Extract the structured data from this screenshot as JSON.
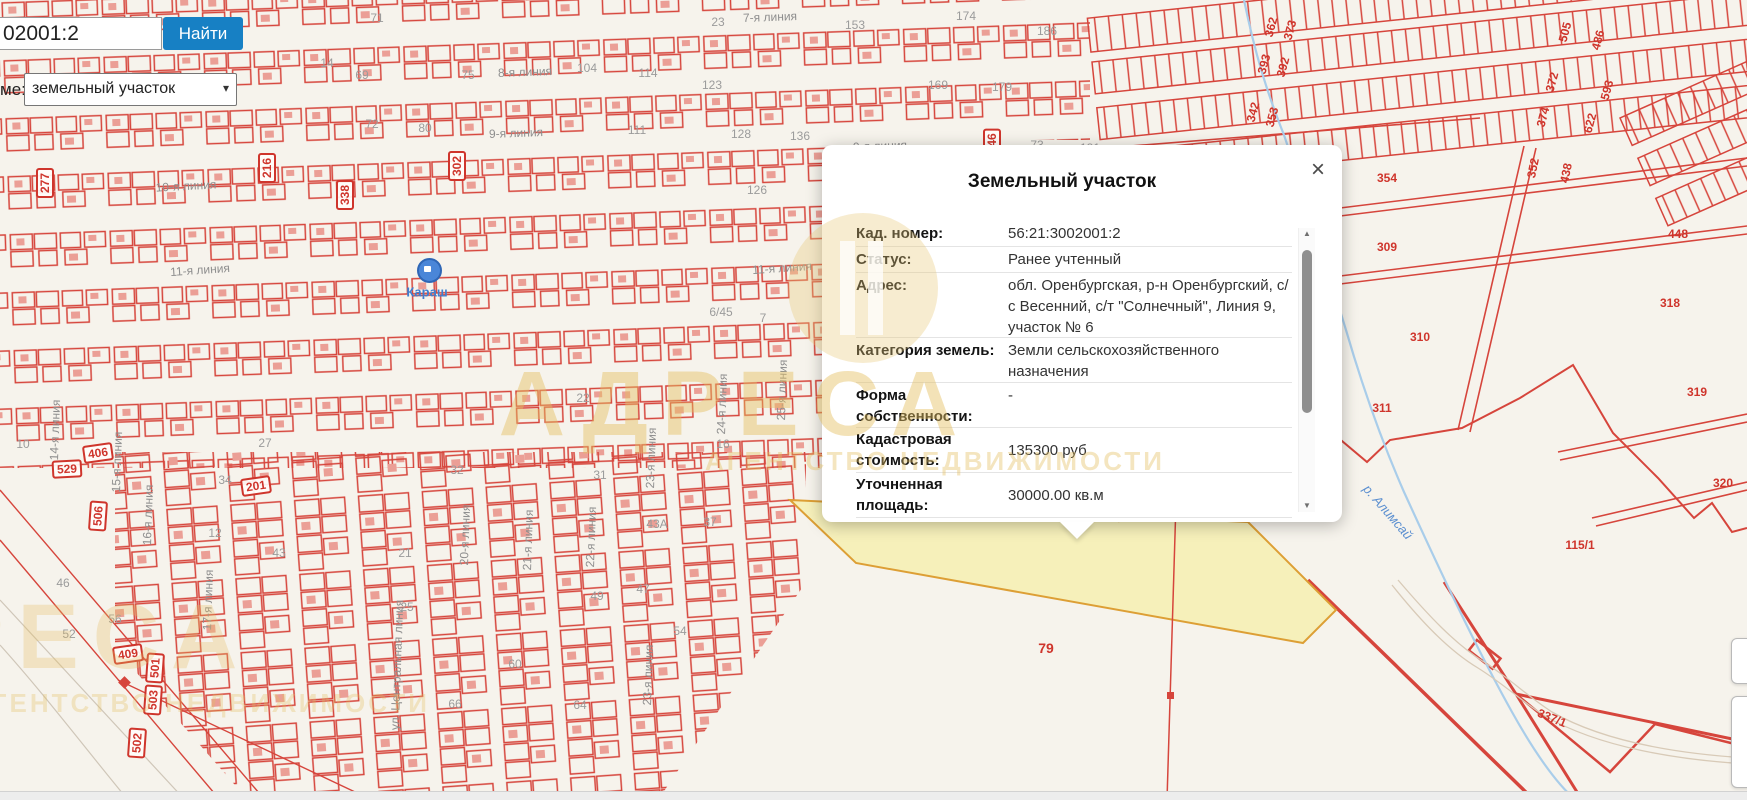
{
  "colors": {
    "accent_blue": "#1780c4",
    "parcel_red": "#d6453c",
    "highlight_fill": "#f6efb2",
    "highlight_border": "#dd9f35",
    "river_blue": "#a9cdea",
    "watermark": "#e4be5f"
  },
  "controls": {
    "search": {
      "value": "02001:2",
      "full_hint": "56:21:3002001:2"
    },
    "find_button": "Найти",
    "layer_label": "ме:",
    "layer_select": {
      "value": "земельный участок"
    }
  },
  "popup": {
    "title": "Земельный участок",
    "close": "×",
    "fields": [
      {
        "label": "Кад. номер:",
        "value": "56:21:3002001:2",
        "h": 25,
        "center": true
      },
      {
        "label": "Статус:",
        "value": "Ранее учтенный",
        "h": 25,
        "center": true
      },
      {
        "label": "Адрес:",
        "value": "обл. Оренбургская, р-н Оренбургский, с/с Весенний, с/т \"Солнечный\", Линия 9, участок № 6",
        "h": 64,
        "center": false
      },
      {
        "label": "Категория земель:",
        "value": "Земли сельскохозяйственного назначения",
        "h": 44,
        "center": false
      },
      {
        "label": "Форма собственности:",
        "value": "-",
        "h": 44,
        "center": false
      },
      {
        "label": "Кадастровая стоимость:",
        "value": "135300 руб",
        "h": 44,
        "center": true
      },
      {
        "label": "Уточненная площадь:",
        "value": "30000.00 кв.м",
        "h": 44,
        "center": true
      },
      {
        "label": "Разрешенное",
        "value": "",
        "h": 40,
        "center": false
      }
    ],
    "scrollbar": {
      "up": "▲",
      "down": "▼"
    }
  },
  "watermark": {
    "word": "АДРЕСА",
    "sub": "АГЕНТСТВО НЕДВИЖИМОСТИ"
  },
  "map": {
    "highlighted_parcel": "79",
    "poi": {
      "name": "Караш"
    },
    "river": {
      "name": "р. Алимсай"
    },
    "labels": [
      {
        "t": "8-я линия",
        "x": 525,
        "y": 72,
        "r": -2,
        "c": "st",
        "n": "street-label"
      },
      {
        "t": "9-я линия",
        "x": 516,
        "y": 133,
        "r": -2,
        "c": "st",
        "n": "street-label"
      },
      {
        "t": "9-я линия",
        "x": 880,
        "y": 146,
        "r": -2,
        "c": "st",
        "n": "street-label"
      },
      {
        "t": "7-я линия",
        "x": 770,
        "y": 17,
        "r": -2,
        "c": "st",
        "n": "street-label"
      },
      {
        "t": "10-я линия",
        "x": 186,
        "y": 186,
        "r": -3,
        "c": "st",
        "n": "street-label"
      },
      {
        "t": "11-я линия",
        "x": 200,
        "y": 270,
        "r": -4,
        "c": "st",
        "n": "street-label"
      },
      {
        "t": "11-я линия",
        "x": 782,
        "y": 268,
        "r": -4,
        "c": "st",
        "n": "street-label"
      },
      {
        "t": "14-я линия",
        "x": 55,
        "y": 430,
        "r": -88,
        "c": "st",
        "n": "street-label"
      },
      {
        "t": "15-я линия",
        "x": 117,
        "y": 462,
        "r": -88,
        "c": "st",
        "n": "street-label"
      },
      {
        "t": "16-я линия",
        "x": 148,
        "y": 515,
        "r": -88,
        "c": "st",
        "n": "street-label"
      },
      {
        "t": "17-я линия",
        "x": 208,
        "y": 600,
        "r": -88,
        "c": "st",
        "n": "street-label"
      },
      {
        "t": "20-я линия",
        "x": 465,
        "y": 535,
        "r": -88,
        "c": "st",
        "n": "street-label"
      },
      {
        "t": "21-я линия",
        "x": 528,
        "y": 540,
        "r": -88,
        "c": "st",
        "n": "street-label"
      },
      {
        "t": "22-я линия",
        "x": 591,
        "y": 537,
        "r": -88,
        "c": "st",
        "n": "street-label"
      },
      {
        "t": "23-я линия",
        "x": 651,
        "y": 458,
        "r": -88,
        "c": "st",
        "n": "street-label"
      },
      {
        "t": "23-я линия",
        "x": 648,
        "y": 675,
        "r": -88,
        "c": "st",
        "n": "street-label"
      },
      {
        "t": "24-я линия",
        "x": 722,
        "y": 404,
        "r": -88,
        "c": "st",
        "n": "street-label"
      },
      {
        "t": "25-я линия",
        "x": 782,
        "y": 390,
        "r": -88,
        "c": "st",
        "n": "street-label"
      },
      {
        "t": "ул. Центральная линия",
        "x": 397,
        "y": 665,
        "r": -88,
        "c": "st",
        "n": "street-label"
      },
      {
        "t": "126",
        "x": 757,
        "y": 190,
        "r": 0,
        "c": "num",
        "n": "lot-number"
      },
      {
        "t": "128",
        "x": 741,
        "y": 134,
        "r": 0,
        "c": "num",
        "n": "lot-number"
      },
      {
        "t": "136",
        "x": 800,
        "y": 136,
        "r": 0,
        "c": "num",
        "n": "lot-number"
      },
      {
        "t": "111",
        "x": 637,
        "y": 130,
        "r": 0,
        "c": "num",
        "n": "lot-number"
      },
      {
        "t": "174",
        "x": 966,
        "y": 16,
        "r": 0,
        "c": "num",
        "n": "lot-number"
      },
      {
        "t": "186",
        "x": 1047,
        "y": 31,
        "r": 0,
        "c": "num",
        "n": "lot-number"
      },
      {
        "t": "153",
        "x": 855,
        "y": 25,
        "r": 0,
        "c": "num",
        "n": "lot-number"
      },
      {
        "t": "169",
        "x": 938,
        "y": 85,
        "r": 0,
        "c": "num",
        "n": "lot-number"
      },
      {
        "t": "179",
        "x": 1002,
        "y": 87,
        "r": 0,
        "c": "num",
        "n": "lot-number"
      },
      {
        "t": "181",
        "x": 1090,
        "y": 148,
        "r": 0,
        "c": "num",
        "n": "lot-number"
      },
      {
        "t": "73",
        "x": 1037,
        "y": 145,
        "r": 0,
        "c": "num",
        "n": "lot-number"
      },
      {
        "t": "71",
        "x": 377,
        "y": 18,
        "r": 0,
        "c": "num",
        "n": "lot-number"
      },
      {
        "t": "104",
        "x": 587,
        "y": 68,
        "r": 0,
        "c": "num",
        "n": "lot-number"
      },
      {
        "t": "114",
        "x": 648,
        "y": 73,
        "r": 0,
        "c": "num",
        "n": "lot-number"
      },
      {
        "t": "123",
        "x": 712,
        "y": 85,
        "r": 0,
        "c": "num",
        "n": "lot-number"
      },
      {
        "t": "23",
        "x": 718,
        "y": 22,
        "r": 0,
        "c": "num",
        "n": "lot-number"
      },
      {
        "t": "14",
        "x": 327,
        "y": 63,
        "r": 0,
        "c": "num",
        "n": "lot-number"
      },
      {
        "t": "69",
        "x": 362,
        "y": 75,
        "r": 0,
        "c": "num",
        "n": "lot-number"
      },
      {
        "t": "75",
        "x": 468,
        "y": 75,
        "r": 0,
        "c": "num",
        "n": "lot-number"
      },
      {
        "t": "72",
        "x": 372,
        "y": 124,
        "r": 0,
        "c": "num",
        "n": "lot-number"
      },
      {
        "t": "80",
        "x": 425,
        "y": 128,
        "r": 0,
        "c": "num",
        "n": "lot-number"
      },
      {
        "t": "32",
        "x": 457,
        "y": 470,
        "r": 0,
        "c": "num",
        "n": "lot-number"
      },
      {
        "t": "21",
        "x": 405,
        "y": 553,
        "r": 0,
        "c": "num",
        "n": "lot-number"
      },
      {
        "t": "25",
        "x": 407,
        "y": 607,
        "r": 0,
        "c": "num",
        "n": "lot-number"
      },
      {
        "t": "49",
        "x": 597,
        "y": 596,
        "r": 0,
        "c": "num",
        "n": "lot-number"
      },
      {
        "t": "47",
        "x": 643,
        "y": 589,
        "r": 0,
        "c": "num",
        "n": "lot-number"
      },
      {
        "t": "54",
        "x": 680,
        "y": 631,
        "r": 0,
        "c": "num",
        "n": "lot-number"
      },
      {
        "t": "60",
        "x": 515,
        "y": 664,
        "r": 0,
        "c": "num",
        "n": "lot-number"
      },
      {
        "t": "66",
        "x": 455,
        "y": 704,
        "r": 0,
        "c": "num",
        "n": "lot-number"
      },
      {
        "t": "64",
        "x": 580,
        "y": 705,
        "r": 0,
        "c": "num",
        "n": "lot-number"
      },
      {
        "t": "31",
        "x": 600,
        "y": 475,
        "r": 0,
        "c": "num",
        "n": "lot-number"
      },
      {
        "t": "22",
        "x": 583,
        "y": 398,
        "r": 0,
        "c": "num",
        "n": "lot-number"
      },
      {
        "t": "16",
        "x": 723,
        "y": 444,
        "r": 0,
        "c": "num",
        "n": "lot-number"
      },
      {
        "t": "43А",
        "x": 657,
        "y": 524,
        "r": 0,
        "c": "num",
        "n": "lot-number"
      },
      {
        "t": "37",
        "x": 710,
        "y": 522,
        "r": 0,
        "c": "num",
        "n": "lot-number"
      },
      {
        "t": "34",
        "x": 225,
        "y": 480,
        "r": 0,
        "c": "num",
        "n": "lot-number"
      },
      {
        "t": "27",
        "x": 265,
        "y": 443,
        "r": 0,
        "c": "num",
        "n": "lot-number"
      },
      {
        "t": "12",
        "x": 215,
        "y": 533,
        "r": 0,
        "c": "num",
        "n": "lot-number"
      },
      {
        "t": "43",
        "x": 279,
        "y": 553,
        "r": 0,
        "c": "num",
        "n": "lot-number"
      },
      {
        "t": "52",
        "x": 69,
        "y": 634,
        "r": 0,
        "c": "num",
        "n": "lot-number"
      },
      {
        "t": "56",
        "x": 115,
        "y": 619,
        "r": 0,
        "c": "num",
        "n": "lot-number"
      },
      {
        "t": "46",
        "x": 63,
        "y": 583,
        "r": 0,
        "c": "num",
        "n": "lot-number"
      },
      {
        "t": "10",
        "x": 23,
        "y": 444,
        "r": 0,
        "c": "num",
        "n": "lot-number"
      },
      {
        "t": "6/45",
        "x": 721,
        "y": 312,
        "r": 0,
        "c": "num",
        "n": "lot-number"
      },
      {
        "t": "7",
        "x": 763,
        "y": 318,
        "r": 0,
        "c": "num",
        "n": "lot-number"
      },
      {
        "t": "354",
        "x": 1387,
        "y": 178,
        "r": 0,
        "c": "red",
        "n": "parcel-number"
      },
      {
        "t": "309",
        "x": 1387,
        "y": 247,
        "r": 0,
        "c": "red",
        "n": "parcel-number"
      },
      {
        "t": "310",
        "x": 1420,
        "y": 337,
        "r": 0,
        "c": "red",
        "n": "parcel-number"
      },
      {
        "t": "311",
        "x": 1382,
        "y": 408,
        "r": 0,
        "c": "red",
        "n": "parcel-number"
      },
      {
        "t": "318",
        "x": 1670,
        "y": 303,
        "r": 0,
        "c": "red",
        "n": "parcel-number"
      },
      {
        "t": "319",
        "x": 1697,
        "y": 392,
        "r": 0,
        "c": "red",
        "n": "parcel-number"
      },
      {
        "t": "320",
        "x": 1723,
        "y": 483,
        "r": 0,
        "c": "red",
        "n": "parcel-number"
      },
      {
        "t": "448",
        "x": 1678,
        "y": 234,
        "r": 0,
        "c": "red",
        "n": "parcel-number"
      },
      {
        "t": "115/1",
        "x": 1580,
        "y": 545,
        "r": 0,
        "c": "red",
        "n": "parcel-number"
      },
      {
        "t": "337/1",
        "x": 1552,
        "y": 718,
        "r": 22,
        "c": "red",
        "n": "parcel-number"
      },
      {
        "t": "352",
        "x": 1533,
        "y": 168,
        "r": -78,
        "c": "red",
        "n": "parcel-number"
      },
      {
        "t": "438",
        "x": 1566,
        "y": 173,
        "r": -78,
        "c": "red",
        "n": "parcel-number"
      },
      {
        "t": "362",
        "x": 1271,
        "y": 27,
        "r": -75,
        "c": "red",
        "n": "parcel-number"
      },
      {
        "t": "373",
        "x": 1290,
        "y": 30,
        "r": -75,
        "c": "red",
        "n": "parcel-number"
      },
      {
        "t": "393",
        "x": 1264,
        "y": 64,
        "r": -75,
        "c": "red",
        "n": "parcel-number"
      },
      {
        "t": "392",
        "x": 1283,
        "y": 67,
        "r": -75,
        "c": "red",
        "n": "parcel-number"
      },
      {
        "t": "342",
        "x": 1253,
        "y": 112,
        "r": -75,
        "c": "red",
        "n": "parcel-number"
      },
      {
        "t": "353",
        "x": 1272,
        "y": 117,
        "r": -75,
        "c": "red",
        "n": "parcel-number"
      },
      {
        "t": "505",
        "x": 1565,
        "y": 32,
        "r": -75,
        "c": "red",
        "n": "parcel-number"
      },
      {
        "t": "486",
        "x": 1598,
        "y": 40,
        "r": -75,
        "c": "red",
        "n": "parcel-number"
      },
      {
        "t": "372",
        "x": 1552,
        "y": 82,
        "r": -75,
        "c": "red",
        "n": "parcel-number"
      },
      {
        "t": "374",
        "x": 1543,
        "y": 117,
        "r": -75,
        "c": "red",
        "n": "parcel-number"
      },
      {
        "t": "593",
        "x": 1607,
        "y": 90,
        "r": -75,
        "c": "red",
        "n": "parcel-number"
      },
      {
        "t": "622",
        "x": 1590,
        "y": 123,
        "r": -75,
        "c": "red",
        "n": "parcel-number"
      },
      {
        "t": "79",
        "x": 1046,
        "y": 648,
        "r": 0,
        "c": "red big",
        "n": "highlighted-parcel-number"
      },
      {
        "t": "216",
        "x": 267,
        "y": 168,
        "r": -90,
        "c": "redbox",
        "n": "parcel-number-boxed"
      },
      {
        "t": "277",
        "x": 45,
        "y": 183,
        "r": -90,
        "c": "redbox",
        "n": "parcel-number-boxed"
      },
      {
        "t": "302",
        "x": 457,
        "y": 166,
        "r": -90,
        "c": "redbox",
        "n": "parcel-number-boxed"
      },
      {
        "t": "338",
        "x": 345,
        "y": 195,
        "r": -90,
        "c": "redbox",
        "n": "parcel-number-boxed"
      },
      {
        "t": "46",
        "x": 992,
        "y": 140,
        "r": -90,
        "c": "redbox",
        "n": "parcel-number-boxed"
      },
      {
        "t": "406",
        "x": 98,
        "y": 453,
        "r": -8,
        "c": "redbox",
        "n": "parcel-number-boxed"
      },
      {
        "t": "529",
        "x": 67,
        "y": 469,
        "r": -3,
        "c": "redbox",
        "n": "parcel-number-boxed"
      },
      {
        "t": "506",
        "x": 98,
        "y": 516,
        "r": -86,
        "c": "redbox",
        "n": "parcel-number-boxed"
      },
      {
        "t": "201",
        "x": 256,
        "y": 486,
        "r": -8,
        "c": "redbox",
        "n": "parcel-number-boxed"
      },
      {
        "t": "409",
        "x": 128,
        "y": 654,
        "r": -8,
        "c": "redbox",
        "n": "parcel-number-boxed"
      },
      {
        "t": "501",
        "x": 155,
        "y": 668,
        "r": -86,
        "c": "redbox",
        "n": "parcel-number-boxed"
      },
      {
        "t": "503",
        "x": 153,
        "y": 700,
        "r": -86,
        "c": "redbox",
        "n": "parcel-number-boxed"
      },
      {
        "t": "502",
        "x": 137,
        "y": 743,
        "r": -86,
        "c": "redbox",
        "n": "parcel-number-boxed"
      },
      {
        "t": "Караш",
        "x": 427,
        "y": 292,
        "r": 0,
        "c": "poi",
        "n": "poi-label-karash"
      },
      {
        "t": "р. Алимсай",
        "x": 1388,
        "y": 512,
        "r": 49,
        "c": "river",
        "n": "river-label"
      }
    ]
  }
}
